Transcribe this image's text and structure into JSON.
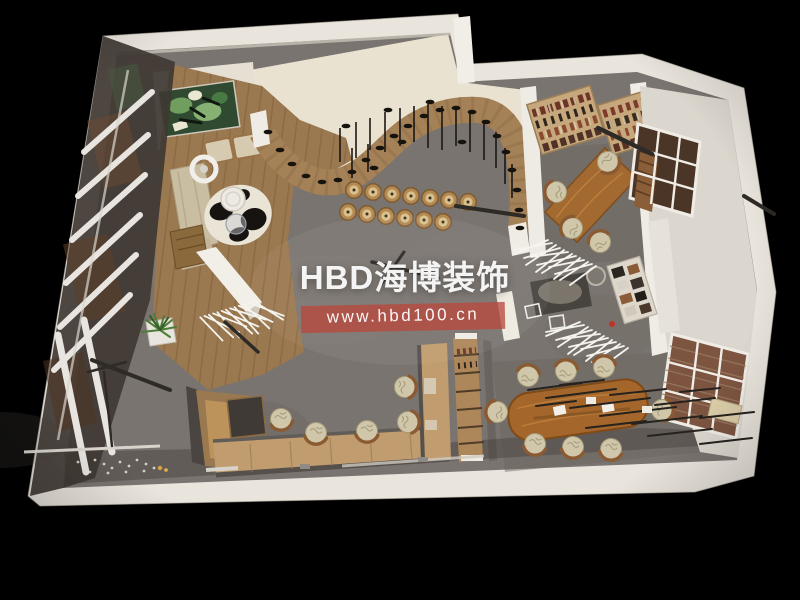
{
  "watermark": {
    "brand": "HBD海博装饰",
    "url": "www.hbd100.cn"
  },
  "colors": {
    "background": "#000000",
    "wall": "#e9e4dc",
    "wall-shade": "#d2ccc2",
    "floor": "#7a7470",
    "floor-dark": "#59544f",
    "cream-floor": "#eae2d1",
    "wood-floor": "#9a7850",
    "plank-line": "#7c5c3b",
    "curve-wood": "#a58157",
    "counter-wood": "#c09c6e",
    "partition-wood": "#ad8659",
    "table-wood": "#a4662a",
    "desk-wood": "#a26a30",
    "chair-seat": "#d0c7ab",
    "chair-frame": "#8a5a32",
    "sofa": "#c9bda2",
    "glass": "#3f3833",
    "mullion": "#e8e5e0",
    "shoe": "#16120e",
    "branch": "#f5f3ee",
    "accent-red": "#b9493d",
    "art-green": "#5d8c4c",
    "brick": "#7c5440",
    "rod": "#2e2a26"
  }
}
